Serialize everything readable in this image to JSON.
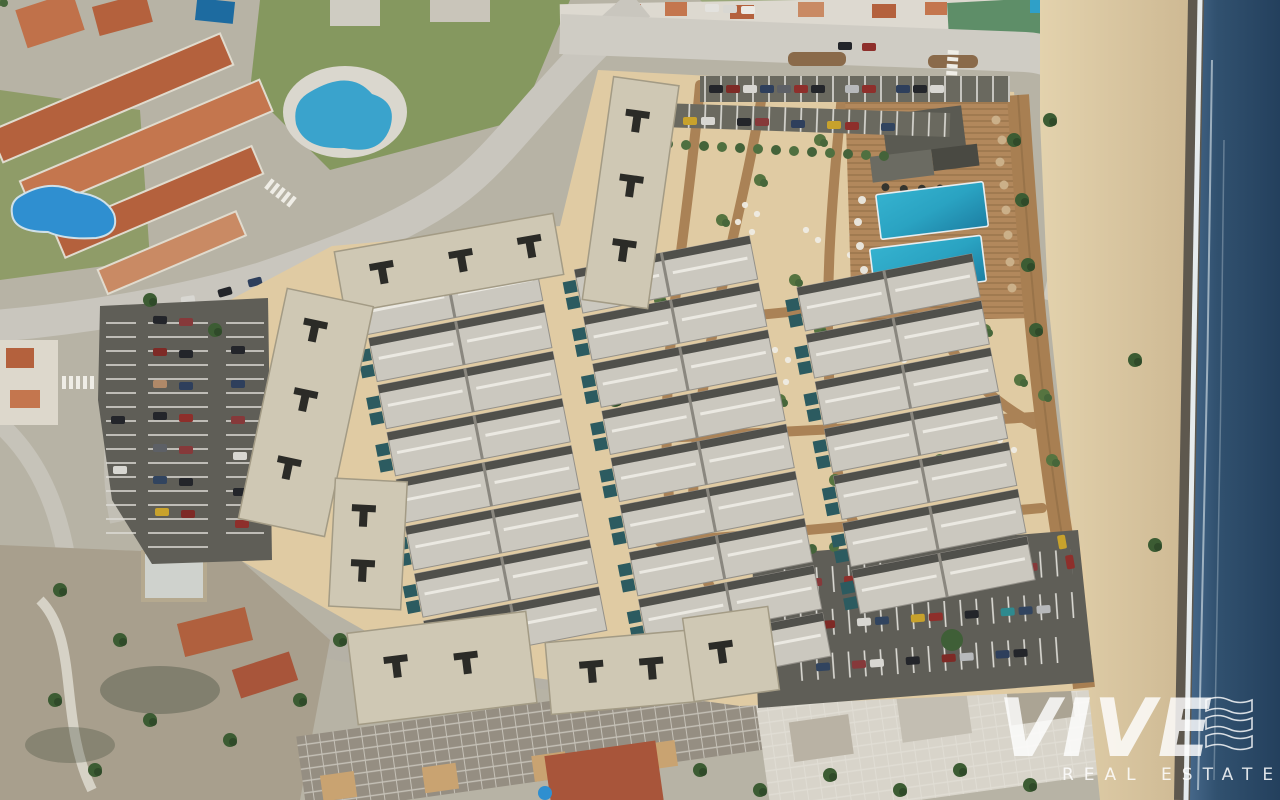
{
  "watermark": {
    "brand": "VIVE",
    "tagline": "REAL ESTATE",
    "logo_icon": "three-wave-bars-icon",
    "color": "#ffffff"
  },
  "scene": {
    "type": "aerial-render-of-beachfront-development",
    "communal_pools_count": 2,
    "areas": [
      "existing-residential-district",
      "access-road",
      "street-parking-lot",
      "apartment-slab-blocks",
      "townhouse-rows-with-plunge-pools",
      "landscaped-garden-with-boardwalk-paths",
      "communal-pool-deck",
      "beach-club",
      "beach-boardwalk",
      "guest-parking-lot",
      "beach",
      "sea"
    ]
  },
  "palette": {
    "sea_deep": "#24405d",
    "sea_light": "#3f6287",
    "surf": "#edf3f6",
    "wet_sand": "#5e584e",
    "beach": "#d7c39e",
    "beach_light": "#e3d2ad",
    "plot_sand": "#e0cba3",
    "boardwalk": "#a87f52",
    "deck_wood": "#b2885c",
    "pool": "#2aa3c2",
    "pool_deep": "#1d7fa3",
    "plunge_pool": "#2c5b60",
    "roof_grey": "#cbc8bf",
    "roof_shadow": "#3f3f3b",
    "slab_roof": "#cfc8b4",
    "asphalt": "#5f5e57",
    "road": "#c9c6be",
    "terracotta": "#b4613d",
    "green_dark": "#3c5c33",
    "green": "#5d7c42",
    "lawn": "#85985f",
    "urban_base": "#b7b3a5"
  }
}
